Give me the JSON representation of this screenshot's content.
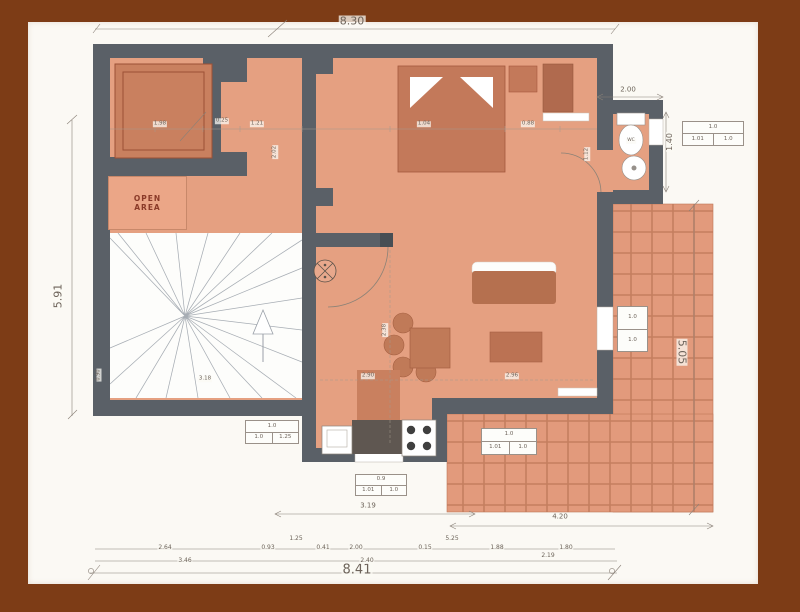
{
  "palette": {
    "frame": "#7d3c16",
    "paper": "#fbf9f4",
    "wall": "#5a6067",
    "wall_dark": "#474e54",
    "floor": "#e5a081",
    "floor_dark": "#c9805f",
    "furniture": "#c3795a",
    "furniture_dark": "#b06a4e",
    "tile": "#e29a7c",
    "tile_line": "#c57e5f",
    "dim_text": "#6d635a",
    "label_red": "#8a3a28"
  },
  "labels": {
    "open_area_l1": "OPEN",
    "open_area_l2": "AREA"
  },
  "dims_main": {
    "top_total": "8.30",
    "left_total": "5.91",
    "right_total": "5.05",
    "bottom_total": "8.41",
    "bath_width": "2.00",
    "bath_depth": "1.40",
    "terrace_width": "4.20"
  },
  "annotations": [
    {
      "t": "8.30",
      "x": 352,
      "y": 21,
      "r": 0,
      "s": 11
    },
    {
      "t": "5.91",
      "x": 58,
      "y": 296,
      "r": -90,
      "s": 11
    },
    {
      "t": "5.05",
      "x": 682,
      "y": 352,
      "r": 90,
      "s": 11
    },
    {
      "t": "8.41",
      "x": 357,
      "y": 570,
      "r": 0,
      "s": 13
    },
    {
      "t": "4.20",
      "x": 560,
      "y": 517,
      "r": 0,
      "s": 7
    },
    {
      "t": "3.19",
      "x": 368,
      "y": 506,
      "r": 0,
      "s": 7
    },
    {
      "t": "2.00",
      "x": 628,
      "y": 90,
      "r": 0,
      "s": 7
    },
    {
      "t": "1.40",
      "x": 670,
      "y": 142,
      "r": -90,
      "s": 8
    },
    {
      "t": "2.64",
      "x": 165,
      "y": 548,
      "r": 0,
      "s": 6
    },
    {
      "t": "0.93",
      "x": 268,
      "y": 548,
      "r": 0,
      "s": 6
    },
    {
      "t": "1.25",
      "x": 296,
      "y": 539,
      "r": 0,
      "s": 6
    },
    {
      "t": "0.41",
      "x": 323,
      "y": 548,
      "r": 0,
      "s": 6
    },
    {
      "t": "2.00",
      "x": 356,
      "y": 548,
      "r": 0,
      "s": 6
    },
    {
      "t": "0.15",
      "x": 425,
      "y": 548,
      "r": 0,
      "s": 6
    },
    {
      "t": "5.25",
      "x": 452,
      "y": 539,
      "r": 0,
      "s": 6
    },
    {
      "t": "1.88",
      "x": 497,
      "y": 548,
      "r": 0,
      "s": 6
    },
    {
      "t": "1.80",
      "x": 566,
      "y": 548,
      "r": 0,
      "s": 6
    },
    {
      "t": "3.46",
      "x": 185,
      "y": 561,
      "r": 0,
      "s": 6
    },
    {
      "t": "2.40",
      "x": 367,
      "y": 561,
      "r": 0,
      "s": 6
    },
    {
      "t": "2.19",
      "x": 548,
      "y": 556,
      "r": 0,
      "s": 6
    },
    {
      "t": "1.98",
      "x": 160,
      "y": 124,
      "r": 0,
      "s": 5.5
    },
    {
      "t": "0.25",
      "x": 222,
      "y": 121,
      "r": 0,
      "s": 5.5
    },
    {
      "t": "1.21",
      "x": 257,
      "y": 124,
      "r": 0,
      "s": 5.5
    },
    {
      "t": "1.04",
      "x": 424,
      "y": 124,
      "r": 0,
      "s": 5.5
    },
    {
      "t": "0.88",
      "x": 528,
      "y": 124,
      "r": 0,
      "s": 5.5
    },
    {
      "t": "2.02",
      "x": 275,
      "y": 152,
      "r": -90,
      "s": 5.5
    },
    {
      "t": "2.38",
      "x": 385,
      "y": 330,
      "r": -90,
      "s": 5.5
    },
    {
      "t": "1.12",
      "x": 587,
      "y": 154,
      "r": -90,
      "s": 5.5
    },
    {
      "t": "2.90",
      "x": 368,
      "y": 376,
      "r": 0,
      "s": 5.5
    },
    {
      "t": "2.96",
      "x": 512,
      "y": 376,
      "r": 0,
      "s": 5.5
    },
    {
      "t": "3.18",
      "x": 205,
      "y": 379,
      "r": 0,
      "s": 5.5
    },
    {
      "t": "0.90",
      "x": 99,
      "y": 375,
      "r": -90,
      "s": 5
    },
    {
      "t": "WC",
      "x": 631,
      "y": 141,
      "r": 0,
      "s": 4.5
    }
  ],
  "spec_boxes": [
    {
      "x": 682,
      "y": 121,
      "w": 62,
      "h": 25,
      "top": "1.0",
      "cells": [
        "1.01",
        "1.0"
      ],
      "vertical": false
    },
    {
      "x": 617,
      "y": 306,
      "w": 31,
      "h": 46,
      "top": "1.0",
      "cells": [
        "1.0"
      ],
      "vertical": true
    },
    {
      "x": 245,
      "y": 420,
      "w": 54,
      "h": 24,
      "top": "1.0",
      "cells": [
        "1.0",
        "1.25"
      ],
      "vertical": false
    },
    {
      "x": 355,
      "y": 474,
      "w": 52,
      "h": 22,
      "top": "0.9",
      "cells": [
        "1.01",
        "1.0"
      ],
      "vertical": false
    },
    {
      "x": 481,
      "y": 428,
      "w": 56,
      "h": 27,
      "top": "1.0",
      "cells": [
        "1.01",
        "1.0"
      ],
      "vertical": false
    }
  ]
}
